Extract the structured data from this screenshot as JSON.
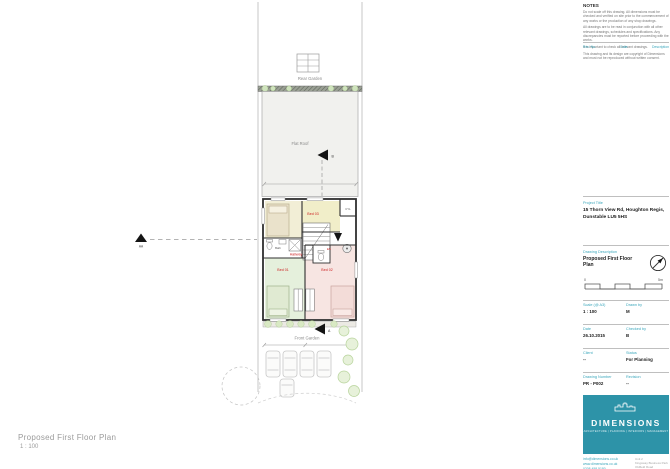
{
  "colors": {
    "accent_teal": "#2d93a8",
    "label_teal": "#3ba7bc",
    "room_label_red": "#cc2222"
  },
  "sheet": {
    "caption_title": "Proposed First Floor Plan",
    "caption_scale": "1 : 100"
  },
  "plan": {
    "labels": {
      "rear_garden": "Rear Garden",
      "flat_roof": "Flat Roof",
      "front_garden": "Front Garden"
    },
    "rooms": {
      "bed1": "Bed 01",
      "bed2": "Bed 02",
      "bed3": "Bed 03",
      "hallway": "Hallway",
      "bath": "Bath",
      "ensuite": "ES",
      "cupboard": "CYL"
    },
    "markers": {
      "section_a": "A",
      "section_b": "B",
      "section_aa": "AA"
    }
  },
  "titleblock": {
    "notes_header": "NOTES",
    "notes_paragraphs": [
      "Do not scale off this drawing. All dimensions must be checked and verified on site prior to the commencement of any works or the production of any shop drawings.",
      "All drawings are to be read in conjunction with all other relevant drawings, schedules and specifications. Any discrepancies must be reported before proceeding with the works.",
      "It is important to check all relevant drawings.",
      "This drawing and its design are copyright of Dimensions and must not be reproduced without written consent."
    ],
    "rev_headers": [
      "Rev. No.",
      "Date",
      "Description"
    ],
    "project_label": "Project Title",
    "project_value": "15 Thorn View Rd, Houghton Regis, Dunstable LU5 5HS",
    "drawing_label": "Drawing Description",
    "drawing_value": "Proposed First Floor Plan",
    "scalebar": {
      "start": "0",
      "end": "5m"
    },
    "fields": [
      {
        "label": "Scale (@ A3)",
        "value": "1 : 100"
      },
      {
        "label": "Drawn by",
        "value": "M"
      },
      {
        "label": "Date",
        "value": "26.10.2015"
      },
      {
        "label": "Checked by",
        "value": "B"
      },
      {
        "label": "Client",
        "value": "--"
      },
      {
        "label": "Status",
        "value": "For Planning"
      },
      {
        "label": "Drawing Number",
        "value": "PR - P002"
      },
      {
        "label": "Revision",
        "value": "--"
      }
    ],
    "logo": {
      "name": "DIMENSIONS",
      "tagline": "ARCHITECTURE | PLANNING | INTERIORS | MANAGEMENT"
    },
    "contact": {
      "email": "info@dimensions.co.uk",
      "web": "www.dimensions.co.uk",
      "phone": "0208 458 5180",
      "address1": "Unit 2",
      "address2": "Kingsway Business Park",
      "address3": "Oldfield Road",
      "address4": "London"
    }
  }
}
